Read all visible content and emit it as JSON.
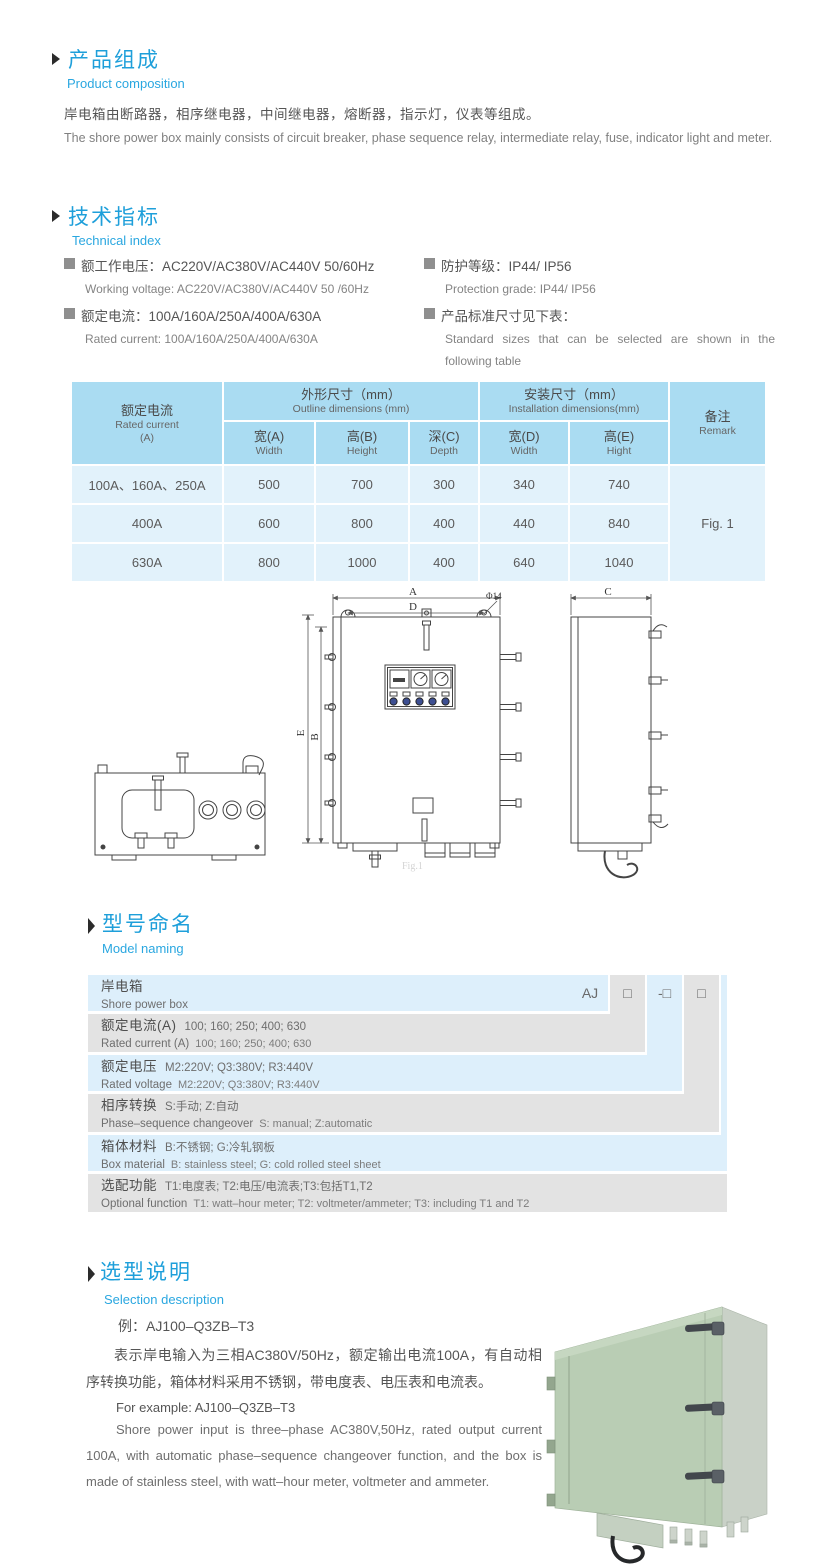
{
  "composition": {
    "title_cn": "产品组成",
    "title_en": "Product  composition",
    "body_cn": "岸电箱由断路器，相序继电器，中间继电器，熔断器，指示灯，仪表等组成。",
    "body_en": "The shore power box mainly consists of circuit breaker, phase sequence relay, intermediate relay, fuse, indicator light and meter."
  },
  "technical": {
    "title_cn": "技术指标",
    "title_en": "Technical index",
    "specs": [
      {
        "cn": "额工作电压：AC220V/AC380V/AC440V  50/60Hz",
        "en": "Working voltage: AC220V/AC380V/AC440V 50 /60Hz"
      },
      {
        "cn": "额定电流：100A/160A/250A/400A/630A",
        "en": "Rated current: 100A/160A/250A/400A/630A"
      },
      {
        "cn": "防护等级：IP44/ IP56",
        "en": "Protection grade: IP44/ IP56"
      },
      {
        "cn": "产品标准尺寸见下表：",
        "en": "Standard sizes that can be selected are shown in the following table"
      }
    ]
  },
  "dim_table": {
    "header": {
      "current_cn": "额定电流",
      "current_en": "Rated current",
      "current_unit": "(A)",
      "outline_cn": "外形尺寸（mm）",
      "outline_en": "Outline dimensions (mm)",
      "install_cn": "安装尺寸（mm）",
      "install_en": "Installation dimensions(mm)",
      "remark_cn": "备注",
      "remark_en": "Remark",
      "sub": [
        {
          "cn": "宽(A)",
          "en": "Width"
        },
        {
          "cn": "高(B)",
          "en": "Height"
        },
        {
          "cn": "深(C)",
          "en": "Depth"
        },
        {
          "cn": "宽(D)",
          "en": "Width"
        },
        {
          "cn": "高(E)",
          "en": "Hight"
        }
      ]
    },
    "rows": [
      {
        "current": "100A、160A、250A",
        "w": "500",
        "h": "700",
        "d": "300",
        "iw": "340",
        "ih": "740"
      },
      {
        "current": "400A",
        "w": "600",
        "h": "800",
        "d": "400",
        "iw": "440",
        "ih": "840"
      },
      {
        "current": "630A",
        "w": "800",
        "h": "1000",
        "d": "400",
        "iw": "640",
        "ih": "1040"
      }
    ],
    "remark_value": "Fig. 1"
  },
  "drawing": {
    "labels": {
      "a": "A",
      "d": "D",
      "dia": "Φ14",
      "e": "E",
      "b": "B",
      "c": "C"
    },
    "caption": "Fig.1"
  },
  "model_naming": {
    "title_cn": "型号命名",
    "title_en": "Model naming",
    "code": {
      "prefix": "AJ",
      "box1": "□",
      "box2": "-□",
      "box3": "□"
    },
    "rows": [
      {
        "label_cn": "岸电箱",
        "label_en": "Shore power box"
      },
      {
        "label_cn": "额定电流(A)",
        "desc_cn": "100; 160; 250; 400; 630",
        "label_en": "Rated current (A)",
        "desc_en": "100; 160; 250; 400; 630"
      },
      {
        "label_cn": "额定电压",
        "desc_cn": "M2:220V;  Q3:380V;  R3:440V",
        "label_en": "Rated voltage",
        "desc_en": "M2:220V;  Q3:380V;  R3:440V"
      },
      {
        "label_cn": "相序转换",
        "desc_cn": "S:手动; Z:自动",
        "label_en": "Phase–sequence changeover",
        "desc_en": "S: manual;  Z:automatic"
      },
      {
        "label_cn": "箱体材料",
        "desc_cn": "B:不锈钢;  G:冷轧钢板",
        "label_en": "Box material",
        "desc_en": "B: stainless steel; G: cold rolled steel sheet"
      },
      {
        "label_cn": "选配功能",
        "desc_cn": "T1:电度表;  T2:电压/电流表;T3:包括T1,T2",
        "label_en": "Optional function",
        "desc_en": "T1: watt–hour meter; T2: voltmeter/ammeter; T3: including T1 and T2"
      }
    ]
  },
  "selection": {
    "title_cn": "选型说明",
    "title_en": "Selection description",
    "example_cn": "例：AJ100–Q3ZB–T3",
    "body_cn": "表示岸电输入为三相AC380V/50Hz，额定输出电流100A，有自动相序转换功能，箱体材料采用不锈钢，带电度表、电压表和电流表。",
    "example_en": "For example: AJ100–Q3ZB–T3",
    "body_en": "Shore power input is three–phase AC380V,50Hz, rated output current 100A, with automatic phase–sequence changeover function, and the box is made of stainless steel, with watt–hour meter, voltmeter and ammeter."
  },
  "colors": {
    "accent_blue": "#1e9fda",
    "table_header_blue": "#aadcf2",
    "table_cell_blue": "#e2f2fb",
    "ladder_blue": "#ddeffb",
    "ladder_gray": "#e3e3e3",
    "photo_green": "#b9cdb4"
  }
}
